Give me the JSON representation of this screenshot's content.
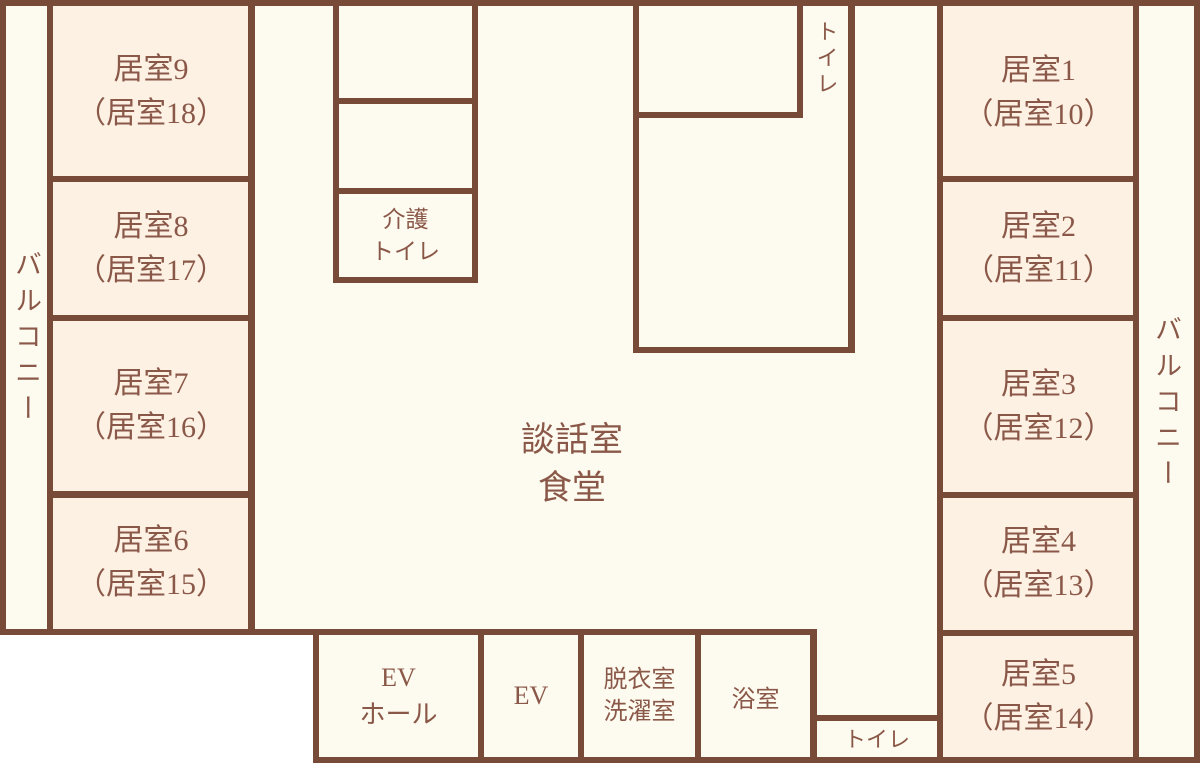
{
  "colors": {
    "wall": "#784a38",
    "text": "#8a5848",
    "room_fill": "#fdf1e4",
    "floor_fill": "#fdfaef",
    "outside": "#ffffff"
  },
  "lounge": {
    "line1": "談話室",
    "line2": "食堂"
  },
  "balcony_left": "バルコニー",
  "balcony_right": "バルコニー",
  "rooms_left": [
    {
      "name": "居室9",
      "alt": "（居室18）"
    },
    {
      "name": "居室8",
      "alt": "（居室17）"
    },
    {
      "name": "居室7",
      "alt": "（居室16）"
    },
    {
      "name": "居室6",
      "alt": "（居室15）"
    }
  ],
  "rooms_right": [
    {
      "name": "居室1",
      "alt": "（居室10）"
    },
    {
      "name": "居室2",
      "alt": "（居室11）"
    },
    {
      "name": "居室3",
      "alt": "（居室12）"
    },
    {
      "name": "居室4",
      "alt": "（居室13）"
    },
    {
      "name": "居室5",
      "alt": "（居室14）"
    }
  ],
  "utilities": {
    "care_toilet": {
      "line1": "介護",
      "line2": "トイレ"
    },
    "toilet_top": "トイレ",
    "toilet_bottom": "トイレ",
    "ev_hall": {
      "line1": "EV",
      "line2": "ホール"
    },
    "ev": "EV",
    "dressing": {
      "line1": "脱衣室",
      "line2": "洗濯室"
    },
    "bath": "浴室"
  }
}
